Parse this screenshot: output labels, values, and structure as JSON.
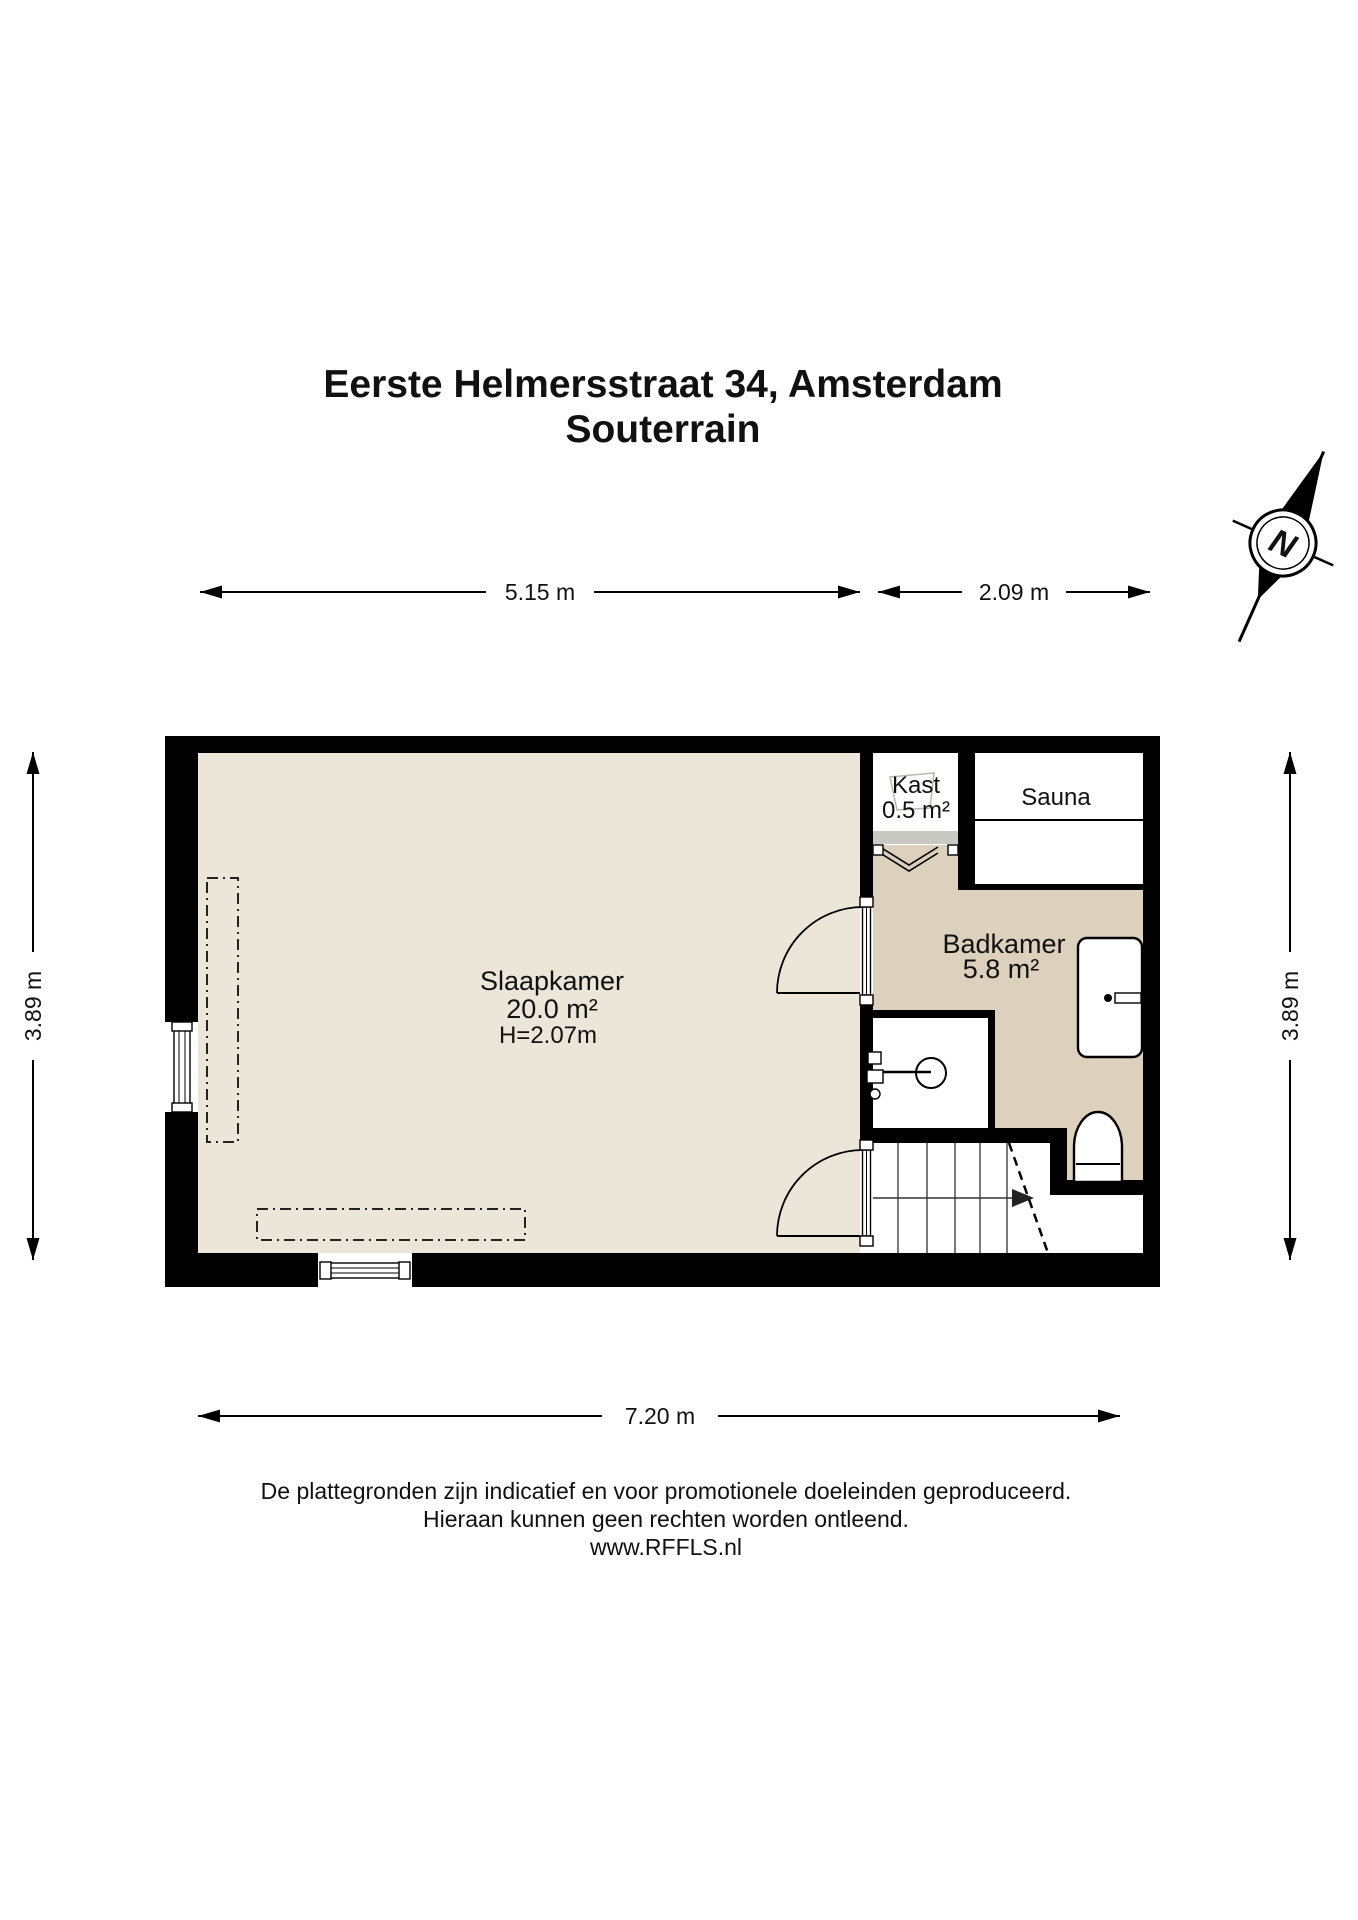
{
  "title": {
    "line1": "Eerste Helmersstraat 34, Amsterdam",
    "line2": "Souterrain"
  },
  "compass": {
    "north_label": "N"
  },
  "dimensions": {
    "top_left": "5.15 m",
    "top_right": "2.09 m",
    "side_left": "3.89 m",
    "side_right": "3.89 m",
    "bottom": "7.20 m"
  },
  "rooms": {
    "slaapkamer": {
      "name": "Slaapkamer",
      "area": "20.0 m²",
      "ceiling": "H=2.07m"
    },
    "badkamer": {
      "name": "Badkamer",
      "area": "5.8 m²"
    },
    "kast": {
      "name": "Kast",
      "area": "0.5 m²"
    },
    "sauna": {
      "name": "Sauna"
    }
  },
  "footer": {
    "line1": "De plattegronden zijn indicatief en voor promotionele doeleinden geproduceerd.",
    "line2": "Hieraan kunnen geen rechten worden ontleend.",
    "line3": "www.RFFLS.nl"
  },
  "colors": {
    "floor_light": "#ebe6d8",
    "floor_dark": "#ddd1bd",
    "wall": "#000000",
    "door_gray": "#c9c9c3"
  }
}
